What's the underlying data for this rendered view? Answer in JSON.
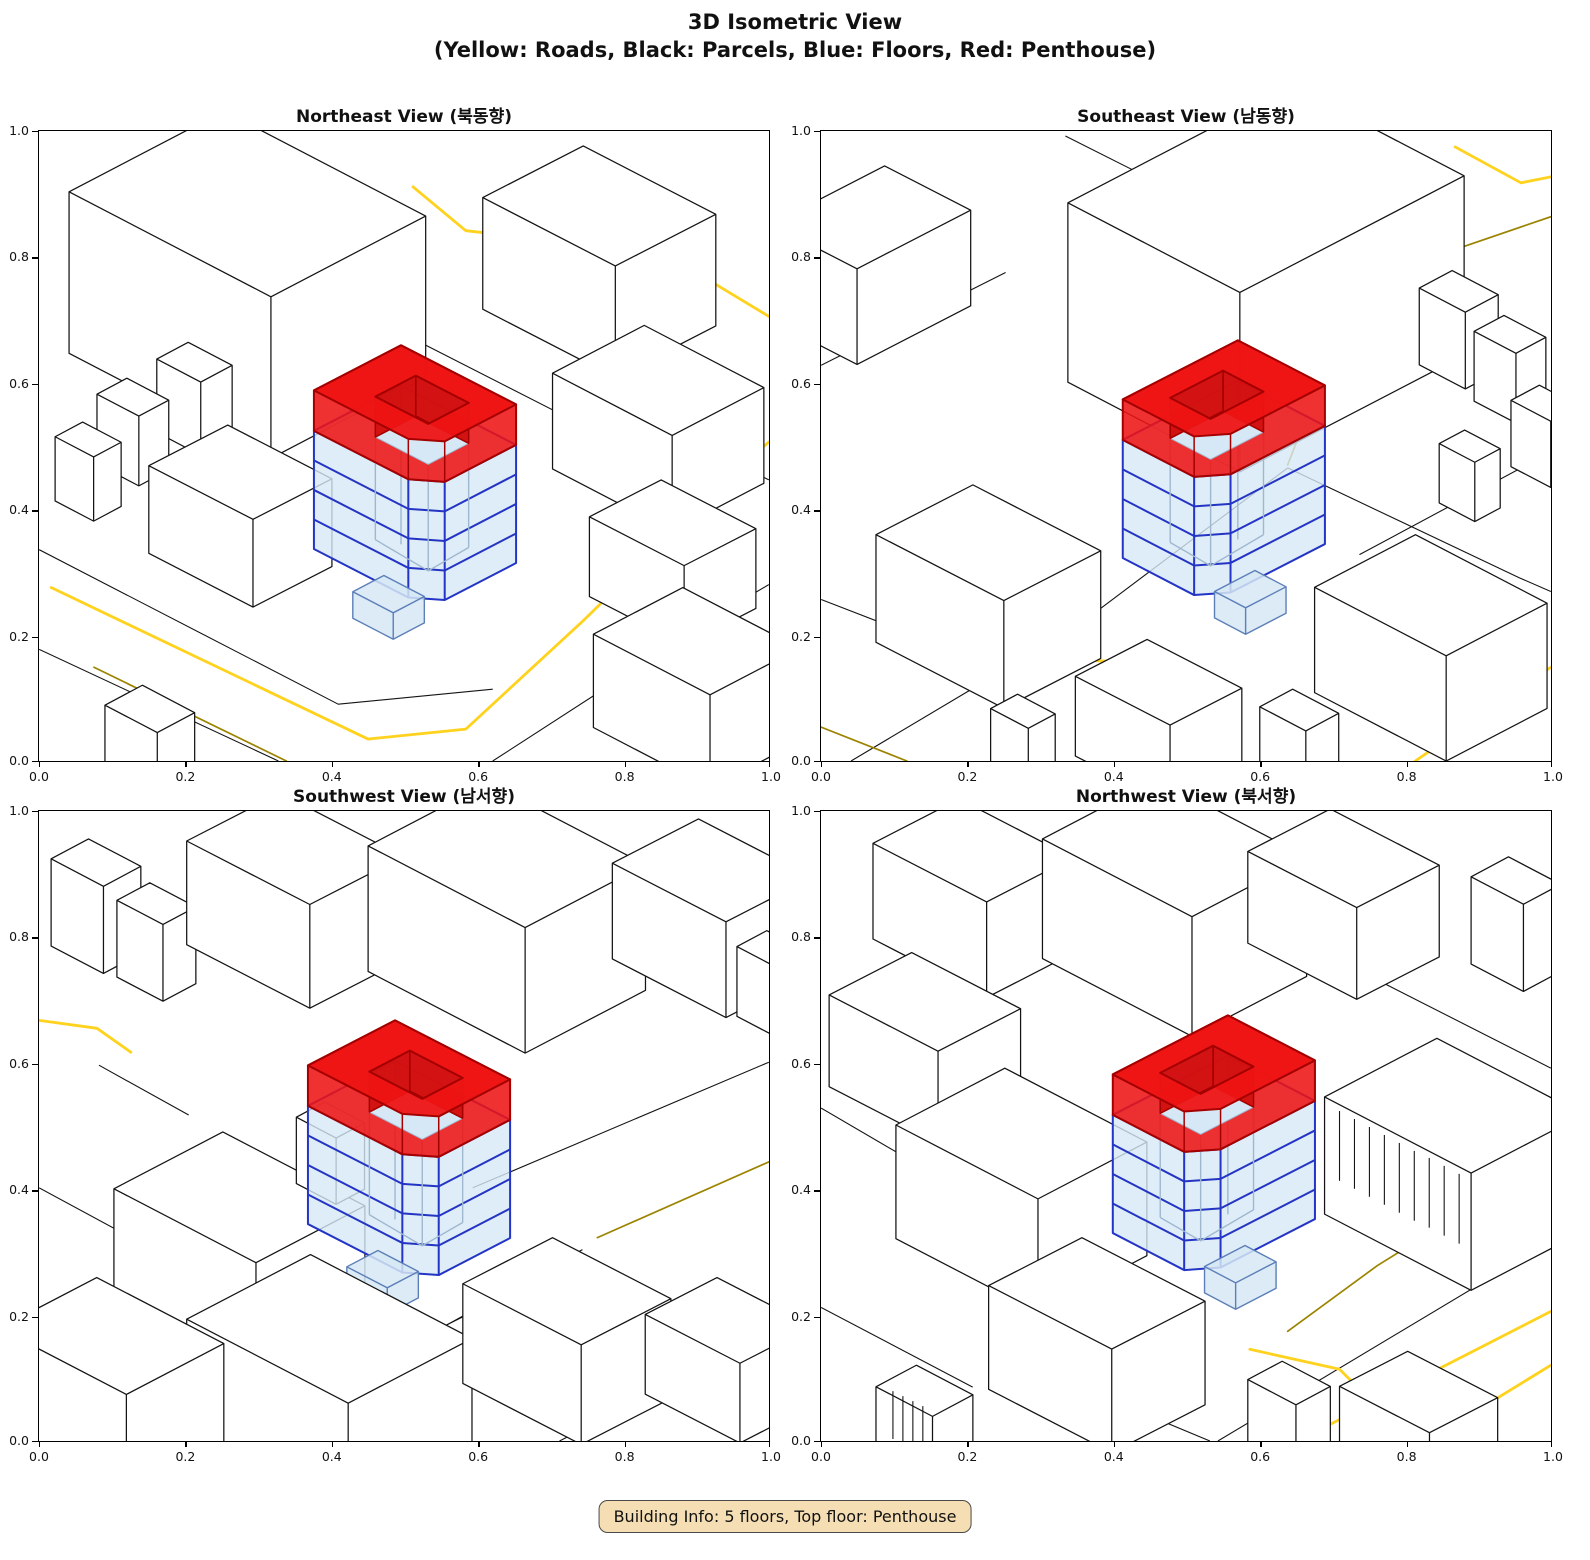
{
  "figure": {
    "suptitle_line1": "3D Isometric View",
    "suptitle_line2": "(Yellow: Roads, Black: Parcels, Blue: Floors, Red: Penthouse)",
    "info_box_text": "Building Info: 5 floors, Top floor: Penthouse"
  },
  "panels": [
    {
      "id": "northeast",
      "title": "Northeast View (북동향)"
    },
    {
      "id": "southeast",
      "title": "Southeast View (남동향)"
    },
    {
      "id": "southwest",
      "title": "Southwest View (남서향)"
    },
    {
      "id": "northwest",
      "title": "Northwest View (북서향)"
    }
  ],
  "axes": {
    "x_ticks": [
      "0.0",
      "0.2",
      "0.4",
      "0.6",
      "0.8",
      "1.0"
    ],
    "y_ticks": [
      "0.0",
      "0.2",
      "0.4",
      "0.6",
      "0.8",
      "1.0"
    ]
  },
  "building": {
    "floors_total": 5,
    "top_floor": "Penthouse"
  },
  "colors": {
    "background": "#FFFFFF",
    "road_yellow": "#FFD21E",
    "road_olive": "#9C8400",
    "parcel_black": "#141414",
    "floor_fill": "#D6E8F5",
    "floor_edge": "#2434C4",
    "floor_inner": "#9FB8CF",
    "penthouse_fill": "#EE1414",
    "penthouse_wall": "#D01010",
    "penthouse_edge": "#A40000",
    "info_bg": "#F5DEB3",
    "info_border": "#4A4A4A"
  }
}
